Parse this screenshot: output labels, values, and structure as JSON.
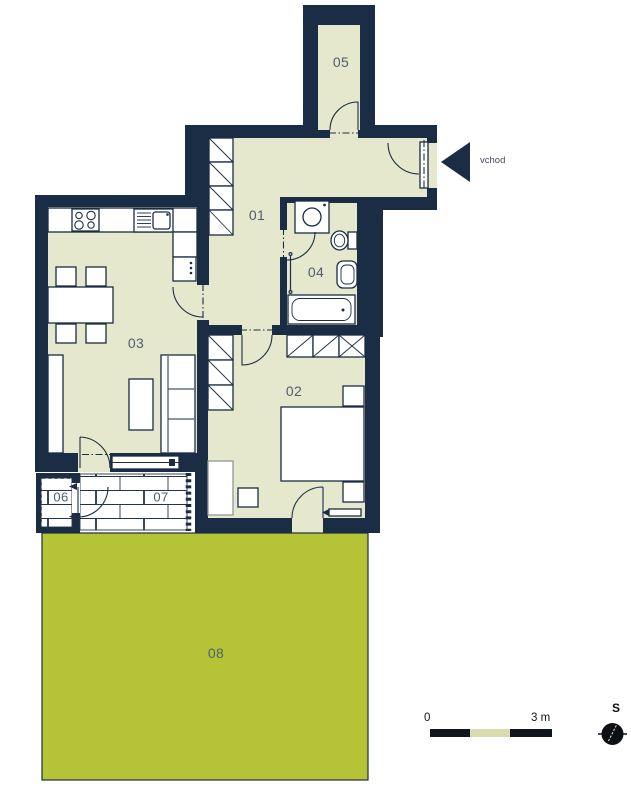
{
  "rooms": {
    "r01": "01",
    "r02": "02",
    "r03": "03",
    "r04": "04",
    "r05": "05",
    "r06": "06",
    "r07": "07",
    "r08": "08"
  },
  "entrance": {
    "label": "vchod"
  },
  "scale_bar": {
    "start": "0",
    "end": "3 m"
  },
  "compass": {
    "north_label": "S"
  },
  "colors": {
    "wall": "#1a2d44",
    "floor": "#e6e8cd",
    "garden": "#b4c436",
    "paving": "#ffffff",
    "scale_mid_segment": "#d8dcae"
  }
}
